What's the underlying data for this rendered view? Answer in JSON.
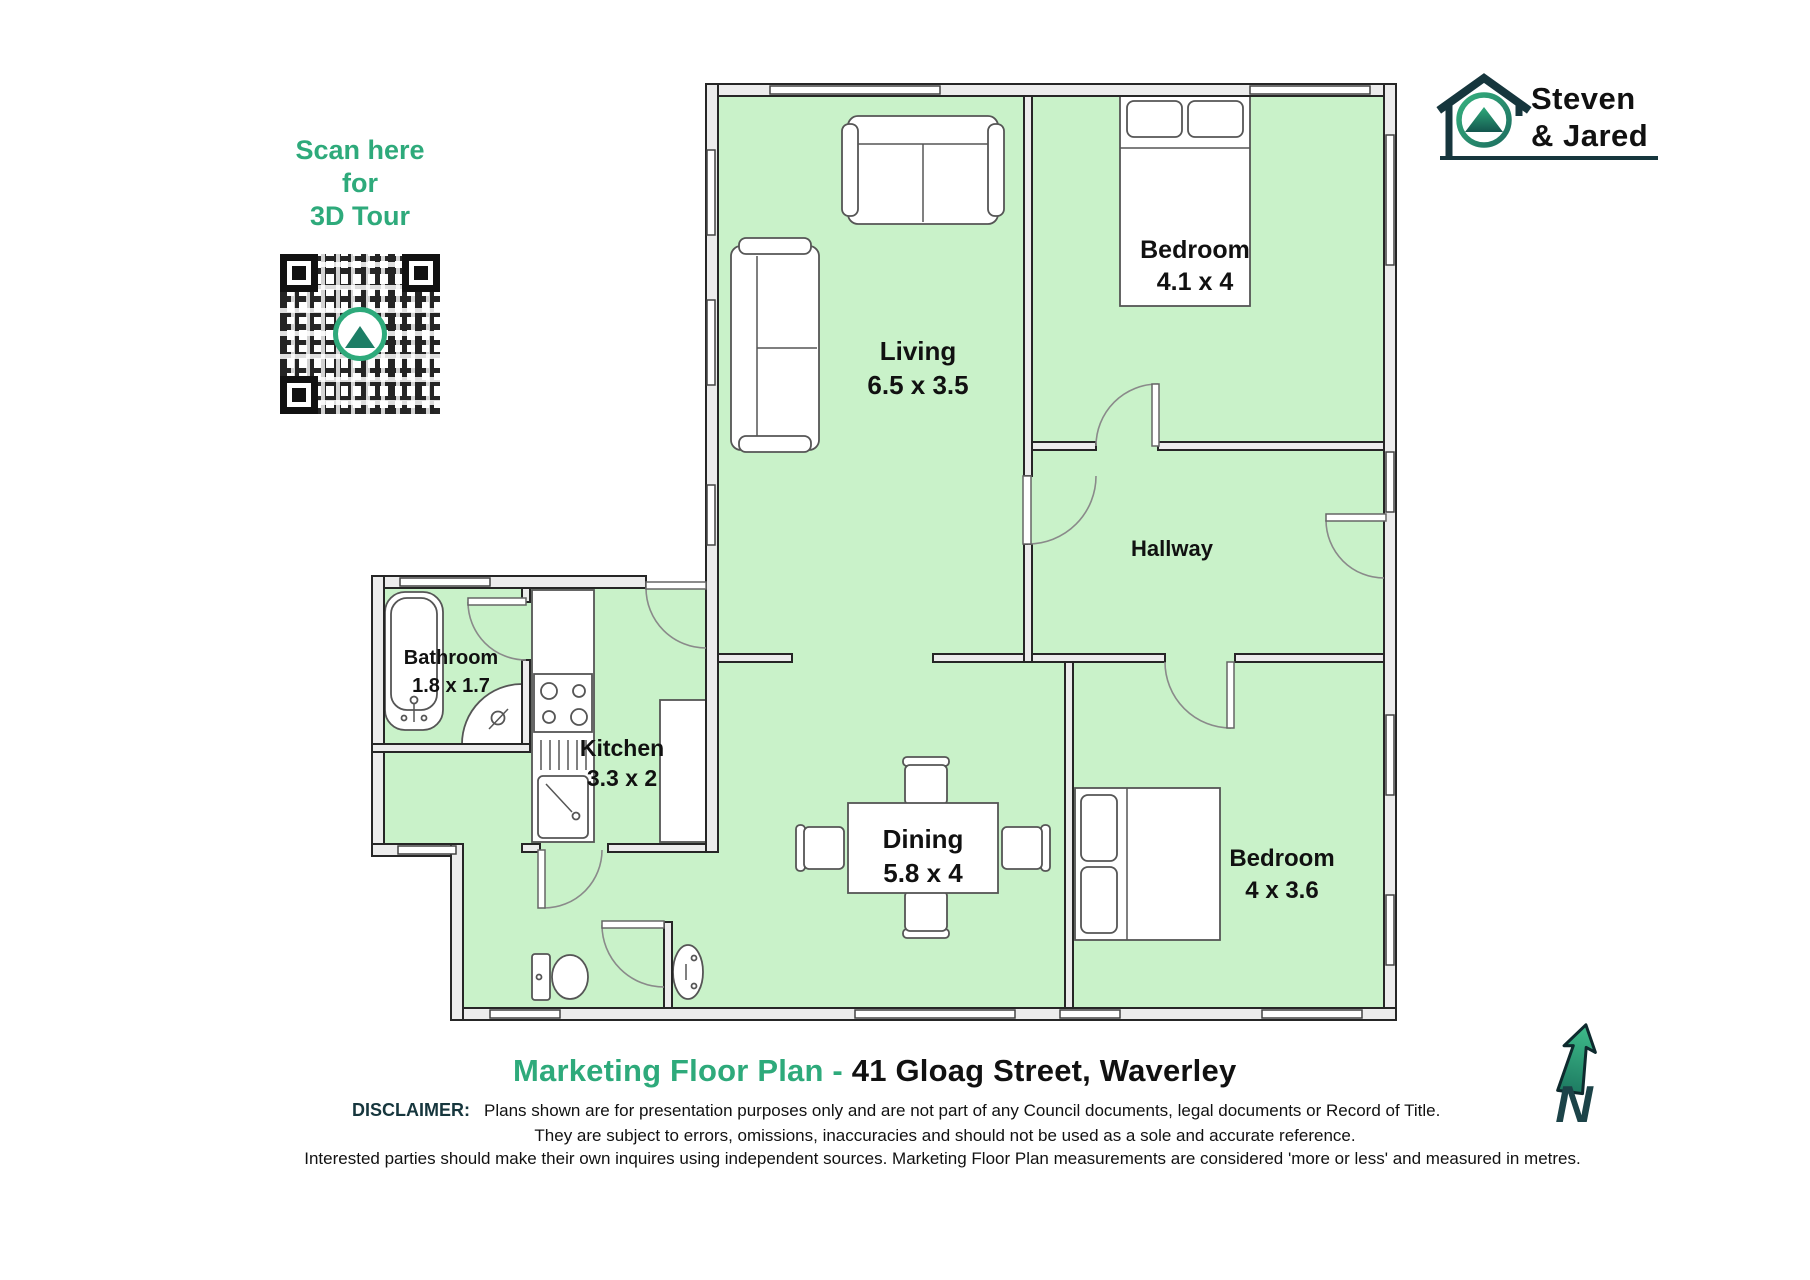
{
  "scan_cta": {
    "line1": "Scan here",
    "line2": "for",
    "line3": "3D Tour"
  },
  "logo": {
    "name_line1": "Steven",
    "name_line2": "& Jared"
  },
  "rooms": {
    "living": {
      "name": "Living",
      "dims": "6.5 x 3.5"
    },
    "bedroom1": {
      "name": "Bedroom",
      "dims": "4.1 x 4"
    },
    "hallway": {
      "name": "Hallway"
    },
    "bathroom": {
      "name": "Bathroom",
      "dims": "1.8 x 1.7"
    },
    "kitchen": {
      "name": "Kitchen",
      "dims": "3.3 x 2"
    },
    "dining": {
      "name": "Dining",
      "dims": "5.8 x 4"
    },
    "bedroom2": {
      "name": "Bedroom",
      "dims": "4 x 3.6"
    }
  },
  "title": {
    "prefix": "Marketing Floor Plan - ",
    "address": "41 Gloag Street, Waverley"
  },
  "disclaimer": {
    "label": "DISCLAIMER:",
    "line1": "Plans shown are for presentation purposes only and are not part of any Council documents, legal documents or Record of Title.",
    "line2": "They are subject to errors, omissions, inaccuracies and should not be used as a sole and accurate reference.",
    "line3": "Interested parties should make their own inquires using independent sources.  Marketing Floor Plan measurements are considered 'more or less' and measured in metres."
  },
  "north_label": "N",
  "colors": {
    "brand_green": "#2EAA7B",
    "dark_teal": "#16363D",
    "floor_green": "#C9F2C9"
  }
}
